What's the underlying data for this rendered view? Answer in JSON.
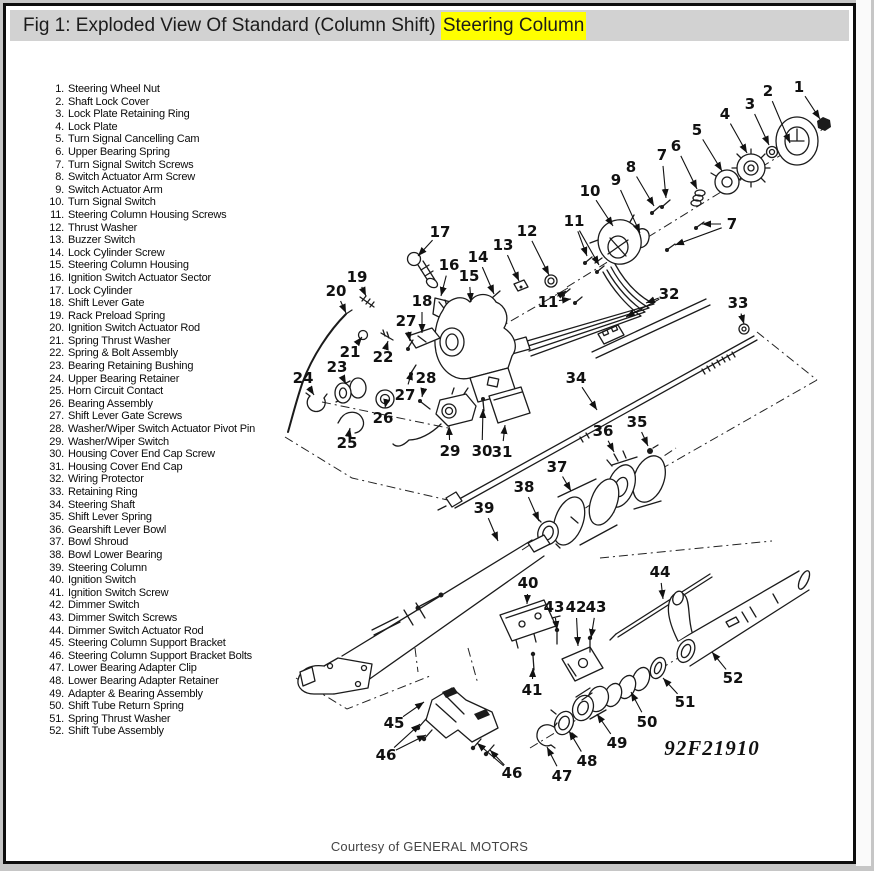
{
  "figure": {
    "title_prefix": "Fig 1: Exploded View Of Standard (Column Shift) ",
    "title_highlight": "Steering Column",
    "highlight_color": "#ffff00",
    "figure_code": "92F21910",
    "credit": "Courtesy of GENERAL MOTORS"
  },
  "parts_list": {
    "items": [
      {
        "n": "1",
        "label": "Steering Wheel Nut"
      },
      {
        "n": "2",
        "label": "Shaft Lock Cover"
      },
      {
        "n": "3",
        "label": "Lock Plate Retaining Ring"
      },
      {
        "n": "4",
        "label": "Lock Plate"
      },
      {
        "n": "5",
        "label": "Turn Signal Cancelling Cam"
      },
      {
        "n": "6",
        "label": "Upper Bearing Spring"
      },
      {
        "n": "7",
        "label": "Turn Signal Switch Screws"
      },
      {
        "n": "8",
        "label": "Switch Actuator Arm Screw"
      },
      {
        "n": "9",
        "label": "Switch Actuator Arm"
      },
      {
        "n": "10",
        "label": "Turn Signal Switch"
      },
      {
        "n": "11",
        "label": "Steering Column Housing Screws"
      },
      {
        "n": "12",
        "label": "Thrust Washer"
      },
      {
        "n": "13",
        "label": "Buzzer Switch"
      },
      {
        "n": "14",
        "label": "Lock Cylinder Screw"
      },
      {
        "n": "15",
        "label": "Steering Column Housing"
      },
      {
        "n": "16",
        "label": "Ignition Switch Actuator Sector"
      },
      {
        "n": "17",
        "label": "Lock Cylinder"
      },
      {
        "n": "18",
        "label": "Shift Lever Gate"
      },
      {
        "n": "19",
        "label": "Rack Preload Spring"
      },
      {
        "n": "20",
        "label": "Ignition Switch Actuator Rod"
      },
      {
        "n": "21",
        "label": "Spring Thrust Washer"
      },
      {
        "n": "22",
        "label": "Spring & Bolt Assembly"
      },
      {
        "n": "23",
        "label": "Bearing Retaining Bushing"
      },
      {
        "n": "24",
        "label": "Upper Bearing Retainer"
      },
      {
        "n": "25",
        "label": "Horn Circuit Contact"
      },
      {
        "n": "26",
        "label": "Bearing Assembly"
      },
      {
        "n": "27",
        "label": "Shift Lever Gate Screws"
      },
      {
        "n": "28",
        "label": "Washer/Wiper Switch Actuator Pivot Pin"
      },
      {
        "n": "29",
        "label": "Washer/Wiper Switch"
      },
      {
        "n": "30",
        "label": "Housing Cover End Cap Screw"
      },
      {
        "n": "31",
        "label": "Housing Cover End Cap"
      },
      {
        "n": "32",
        "label": "Wiring Protector"
      },
      {
        "n": "33",
        "label": "Retaining Ring"
      },
      {
        "n": "34",
        "label": "Steering Shaft"
      },
      {
        "n": "35",
        "label": "Shift Lever Spring"
      },
      {
        "n": "36",
        "label": "Gearshift Lever Bowl"
      },
      {
        "n": "37",
        "label": "Bowl Shroud"
      },
      {
        "n": "38",
        "label": "Bowl Lower Bearing"
      },
      {
        "n": "39",
        "label": "Steering Column"
      },
      {
        "n": "40",
        "label": "Ignition Switch"
      },
      {
        "n": "41",
        "label": "Ignition Switch Screw"
      },
      {
        "n": "42",
        "label": "Dimmer Switch"
      },
      {
        "n": "43",
        "label": "Dimmer Switch Screws"
      },
      {
        "n": "44",
        "label": "Dimmer Switch Actuator Rod"
      },
      {
        "n": "45",
        "label": "Steering Column Support Bracket"
      },
      {
        "n": "46",
        "label": "Steering Column Support Bracket Bolts"
      },
      {
        "n": "47",
        "label": "Lower Bearing Adapter Clip"
      },
      {
        "n": "48",
        "label": "Lower Bearing Adapter Retainer"
      },
      {
        "n": "49",
        "label": "Adapter & Bearing Assembly"
      },
      {
        "n": "50",
        "label": "Shift Tube Return Spring"
      },
      {
        "n": "51",
        "label": "Spring Thrust Washer"
      },
      {
        "n": "52",
        "label": "Shift Tube Assembly"
      }
    ]
  },
  "callouts": [
    {
      "t": "1",
      "x": 799,
      "y": 87,
      "a": [
        [
          820,
          119
        ]
      ]
    },
    {
      "t": "2",
      "x": 768,
      "y": 91,
      "a": [
        [
          790,
          143
        ]
      ]
    },
    {
      "t": "3",
      "x": 750,
      "y": 104,
      "a": [
        [
          769,
          145
        ]
      ]
    },
    {
      "t": "4",
      "x": 725,
      "y": 114,
      "a": [
        [
          747,
          153
        ]
      ]
    },
    {
      "t": "5",
      "x": 697,
      "y": 130,
      "a": [
        [
          722,
          171
        ]
      ]
    },
    {
      "t": "6",
      "x": 676,
      "y": 146,
      "a": [
        [
          697,
          189
        ]
      ]
    },
    {
      "t": "7",
      "x": 662,
      "y": 155,
      "a": [
        [
          666,
          198
        ]
      ]
    },
    {
      "t": "8",
      "x": 631,
      "y": 167,
      "a": [
        [
          654,
          206
        ]
      ]
    },
    {
      "t": "9",
      "x": 616,
      "y": 180,
      "a": [
        [
          640,
          233
        ]
      ]
    },
    {
      "t": "10",
      "x": 590,
      "y": 191,
      "a": [
        [
          613,
          226
        ]
      ]
    },
    {
      "t": "11",
      "x": 574,
      "y": 221,
      "a": [
        [
          587,
          256
        ],
        [
          599,
          265
        ]
      ]
    },
    {
      "t": "7",
      "x": 732,
      "y": 224,
      "a": [
        [
          702,
          224
        ],
        [
          675,
          245
        ]
      ]
    },
    {
      "t": "12",
      "x": 527,
      "y": 231,
      "a": [
        [
          549,
          275
        ]
      ]
    },
    {
      "t": "13",
      "x": 503,
      "y": 245,
      "a": [
        [
          519,
          281
        ]
      ]
    },
    {
      "t": "14",
      "x": 478,
      "y": 257,
      "a": [
        [
          494,
          294
        ]
      ]
    },
    {
      "t": "17",
      "x": 440,
      "y": 232,
      "a": [
        [
          418,
          256
        ]
      ]
    },
    {
      "t": "16",
      "x": 449,
      "y": 265,
      "a": [
        [
          441,
          296
        ]
      ]
    },
    {
      "t": "15",
      "x": 469,
      "y": 276,
      "a": [
        [
          471,
          302
        ]
      ]
    },
    {
      "t": "19",
      "x": 357,
      "y": 277,
      "a": [
        [
          366,
          296
        ]
      ]
    },
    {
      "t": "20",
      "x": 336,
      "y": 291,
      "a": [
        [
          346,
          313
        ]
      ]
    },
    {
      "t": "18",
      "x": 422,
      "y": 301,
      "a": [
        [
          422,
          333
        ]
      ]
    },
    {
      "t": "27",
      "x": 406,
      "y": 321,
      "a": [
        [
          410,
          341
        ]
      ]
    },
    {
      "t": "21",
      "x": 350,
      "y": 352,
      "a": [
        [
          362,
          337
        ]
      ]
    },
    {
      "t": "22",
      "x": 383,
      "y": 357,
      "a": [
        [
          388,
          341
        ]
      ]
    },
    {
      "t": "23",
      "x": 337,
      "y": 367,
      "a": [
        [
          346,
          384
        ]
      ]
    },
    {
      "t": "24",
      "x": 303,
      "y": 378,
      "a": [
        [
          314,
          395
        ]
      ]
    },
    {
      "t": "26",
      "x": 383,
      "y": 418,
      "a": [
        [
          385,
          408
        ]
      ]
    },
    {
      "t": "25",
      "x": 347,
      "y": 443,
      "a": [
        [
          350,
          428
        ]
      ]
    },
    {
      "t": "27",
      "x": 405,
      "y": 395,
      "a": [
        [
          412,
          371
        ]
      ]
    },
    {
      "t": "28",
      "x": 426,
      "y": 378,
      "a": [
        [
          422,
          397
        ]
      ]
    },
    {
      "t": "29",
      "x": 450,
      "y": 451,
      "a": [
        [
          449,
          426
        ]
      ]
    },
    {
      "t": "30",
      "x": 482,
      "y": 451,
      "a": [
        [
          483,
          409
        ]
      ]
    },
    {
      "t": "31",
      "x": 502,
      "y": 452,
      "a": [
        [
          505,
          425
        ]
      ]
    },
    {
      "t": "11",
      "x": 548,
      "y": 302,
      "a": [
        [
          566,
          291
        ],
        [
          571,
          299
        ]
      ]
    },
    {
      "t": "32",
      "x": 669,
      "y": 294,
      "a": [
        [
          646,
          303
        ],
        [
          626,
          317
        ]
      ]
    },
    {
      "t": "33",
      "x": 738,
      "y": 303,
      "a": [
        [
          744,
          324
        ]
      ]
    },
    {
      "t": "34",
      "x": 576,
      "y": 378,
      "a": [
        [
          597,
          410
        ]
      ]
    },
    {
      "t": "35",
      "x": 637,
      "y": 422,
      "a": [
        [
          648,
          446
        ]
      ]
    },
    {
      "t": "36",
      "x": 603,
      "y": 431,
      "a": [
        [
          614,
          452
        ]
      ]
    },
    {
      "t": "37",
      "x": 557,
      "y": 467,
      "a": [
        [
          571,
          491
        ]
      ]
    },
    {
      "t": "38",
      "x": 524,
      "y": 487,
      "a": [
        [
          539,
          521
        ]
      ]
    },
    {
      "t": "39",
      "x": 484,
      "y": 508,
      "a": [
        [
          498,
          541
        ]
      ]
    },
    {
      "t": "40",
      "x": 528,
      "y": 583,
      "a": [
        [
          527,
          604
        ]
      ]
    },
    {
      "t": "43",
      "x": 554,
      "y": 607,
      "a": [
        [
          557,
          630
        ]
      ]
    },
    {
      "t": "42",
      "x": 576,
      "y": 607,
      "a": [
        [
          578,
          646
        ]
      ]
    },
    {
      "t": "43",
      "x": 596,
      "y": 607,
      "a": [
        [
          591,
          638
        ]
      ]
    },
    {
      "t": "44",
      "x": 660,
      "y": 572,
      "a": [
        [
          663,
          599
        ]
      ]
    },
    {
      "t": "41",
      "x": 532,
      "y": 690,
      "a": [
        [
          533,
          668
        ]
      ]
    },
    {
      "t": "45",
      "x": 394,
      "y": 723,
      "a": [
        [
          424,
          702
        ]
      ]
    },
    {
      "t": "46",
      "x": 386,
      "y": 755,
      "a": [
        [
          420,
          724
        ],
        [
          426,
          735
        ]
      ]
    },
    {
      "t": "46",
      "x": 512,
      "y": 773,
      "a": [
        [
          477,
          743
        ],
        [
          490,
          750
        ]
      ]
    },
    {
      "t": "47",
      "x": 562,
      "y": 776,
      "a": [
        [
          547,
          747
        ]
      ]
    },
    {
      "t": "48",
      "x": 587,
      "y": 761,
      "a": [
        [
          569,
          731
        ]
      ]
    },
    {
      "t": "49",
      "x": 617,
      "y": 743,
      "a": [
        [
          597,
          714
        ]
      ]
    },
    {
      "t": "50",
      "x": 647,
      "y": 722,
      "a": [
        [
          631,
          692
        ]
      ]
    },
    {
      "t": "51",
      "x": 685,
      "y": 702,
      "a": [
        [
          663,
          678
        ]
      ]
    },
    {
      "t": "52",
      "x": 733,
      "y": 678,
      "a": [
        [
          712,
          652
        ]
      ]
    }
  ]
}
